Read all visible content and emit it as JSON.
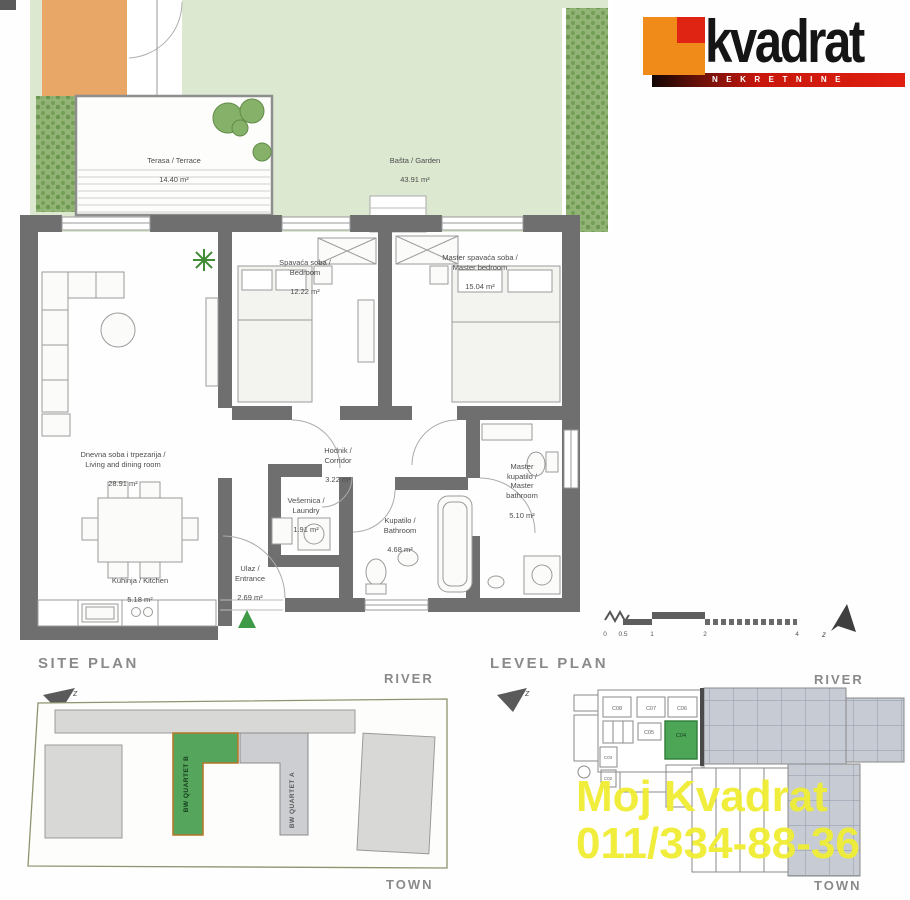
{
  "brand": {
    "logo_text": "kvadrat",
    "logo_sub": "NEKRETNINE"
  },
  "floor_plan": {
    "outdoor": {
      "terrace": {
        "name": "Terasa / Terrace",
        "area": "14.40 m²"
      },
      "garden": {
        "name": "Bašta / Garden",
        "area": "43.91 m²"
      }
    },
    "rooms": {
      "bedroom": {
        "name": "Spavaća soba /\nBedroom",
        "area": "12.22 m²"
      },
      "master_bedroom": {
        "name": "Master spavaća soba /\nMaster bedroom",
        "area": "15.04 m²"
      },
      "living": {
        "name": "Dnevna soba i trpezarija /\nLiving and dining room",
        "area": "28.91 m²"
      },
      "corridor": {
        "name": "Hodnik /\nCorridor",
        "area": "3.22 m²"
      },
      "laundry": {
        "name": "Vešernica /\nLaundry",
        "area": "1.91 m²"
      },
      "bathroom": {
        "name": "Kupatilo /\nBathroom",
        "area": "4.68 m²"
      },
      "master_bathroom": {
        "name": "Master\nkupatilo /\nMaster\nbathroom",
        "area": "5.10 m²"
      },
      "kitchen": {
        "name": "Kuhinja / Kitchen",
        "area": "5.18 m²"
      },
      "entrance": {
        "name": "Ulaz /\nEntrance",
        "area": "2.69 m²"
      }
    }
  },
  "site_plan": {
    "title": "SITE PLAN",
    "river": "RIVER",
    "town": "TOWN",
    "compass": "z",
    "building_b": "BW QUARTET B",
    "building_a": "BW QUARTET A"
  },
  "level_plan": {
    "title": "LEVEL PLAN",
    "river": "RIVER",
    "town": "TOWN",
    "compass": "z",
    "north_mark": "z",
    "scale_ticks": [
      "0",
      "0.5",
      "1",
      "2",
      "4"
    ],
    "units": {
      "c08": "C08",
      "c07": "C07",
      "c06": "C06",
      "c05": "C05",
      "c04": "C04",
      "c03": "C03",
      "c02": "C02"
    },
    "highlighted_unit": "C04"
  },
  "watermark": {
    "line1": "Moj Kvadrat",
    "line2": "011/334-88-36"
  },
  "colors": {
    "logo_orange": "#f08a18",
    "logo_red": "#e02414",
    "logo_bar_red": "#c8170c",
    "garden_green": "#dce8d0",
    "hedge_green": "#93b477",
    "wall_gray": "#6f6f6f",
    "highlight_green": "#4da556",
    "site_building_green": "#55a55c",
    "watermark_yellow": "#f0ed33"
  }
}
